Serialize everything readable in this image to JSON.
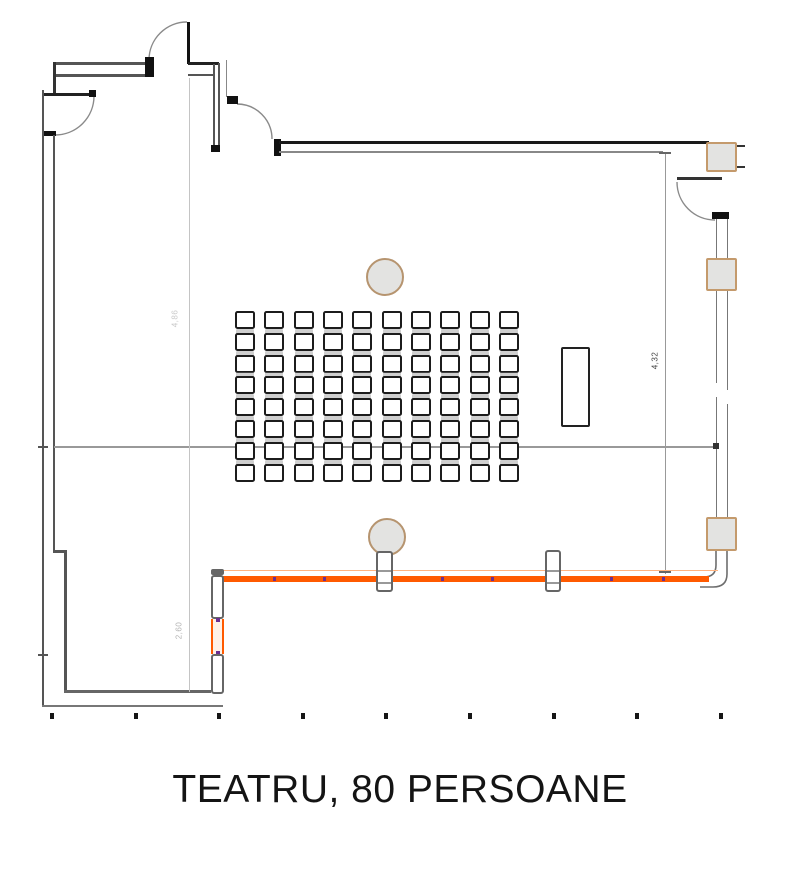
{
  "title": {
    "text": "TEATRU, 80 PERSOANE"
  },
  "plan": {
    "seating": {
      "rows": 8,
      "cols": 10,
      "total_seats": 80
    },
    "dimensions": {
      "left_label": "4,86",
      "alcove_label": "2,60",
      "right_label": "4,32"
    },
    "counts": {
      "round_columns": 2,
      "window_mullions": 3,
      "wall_pillars": 2,
      "grid_ticks": 9,
      "orange_wall_markers": 6,
      "doors": 4
    },
    "colors": {
      "accent_orange": "#ff5a00",
      "accent_orange_light": "#ffb380",
      "beige_border": "#c49a6c",
      "wall_gray": "#555555",
      "seat_border": "#1c1c1c",
      "column_fill": "#e3e3e1",
      "column_border": "#b6946f",
      "marker_purple": "#6b2e91",
      "title_ink": "#141414"
    }
  }
}
